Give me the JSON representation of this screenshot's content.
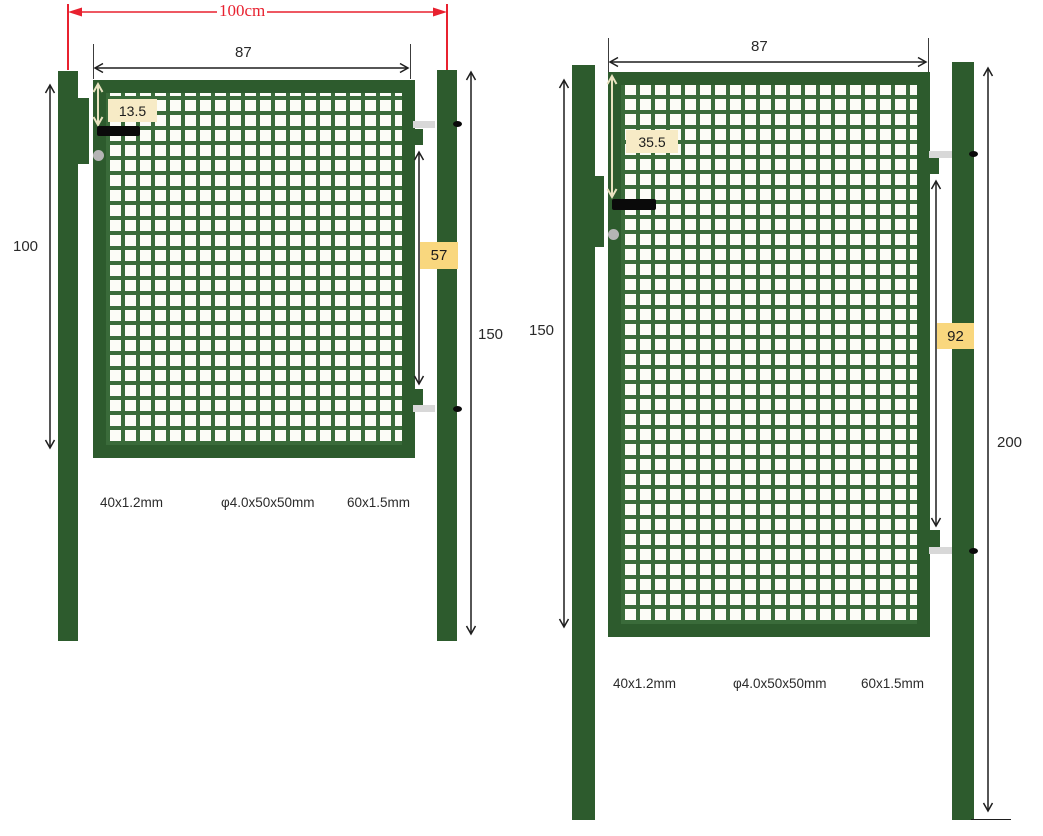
{
  "diagram": {
    "gate1": {
      "overall_width": "100cm",
      "frame_width": "87",
      "handle_offset": "13.5",
      "hinge_spacing": "57",
      "gate_height": "100",
      "post_height": "150",
      "spec_frame": "40x1.2mm",
      "spec_mesh": "φ4.0x50x50mm",
      "spec_post": "60x1.5mm"
    },
    "gate2": {
      "frame_width": "87",
      "handle_offset": "35.5",
      "hinge_spacing": "92",
      "gate_height": "150",
      "post_height": "200",
      "spec_frame": "40x1.2mm",
      "spec_mesh": "φ4.0x50x50mm",
      "spec_post": "60x1.5mm"
    },
    "colors": {
      "frame_green": "#2d5b2d",
      "mesh_green": "#3a6b3a",
      "dimension_red": "#e8212f",
      "label_cream": "#f7ebc6",
      "label_gold": "#f9d77e",
      "hinge_grey": "#d8d8d8",
      "line_black": "#1e1e1e"
    }
  }
}
